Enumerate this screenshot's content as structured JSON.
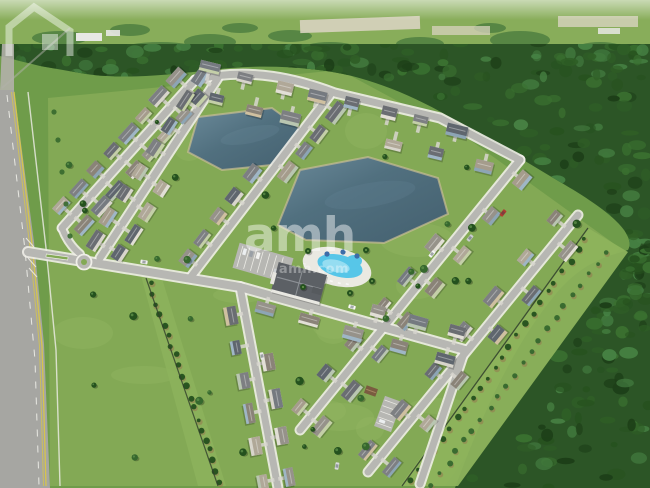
{
  "image_type": "aerial-photograph",
  "watermark": {
    "logo_text": "amh",
    "logo_caption": "amh.com",
    "icon": "house-outline-icon",
    "color": "rgba(255,255,255,0.45)",
    "color_dim": "rgba(255,255,255,0.34)"
  },
  "scene": {
    "description": "Aerial drone view of a suburban residential community with two retention ponds, a clubhouse and swimming pool amenity area, curving street grid, a main road on the left, planted buffer rows and dense forest on the right, distant farmland on the horizon",
    "colors": {
      "haze": "#c3d4c6",
      "field": "#88ad5a",
      "hedge": "#4b7c3e",
      "sand": "#d8d3bf",
      "structure": "#e8e8e4",
      "forest": "#2c5526",
      "lawn": "#83a955",
      "lawn_outer": "#6f9c4a",
      "lawn_light": "#97ba66",
      "buffer": "#8db35c",
      "pond": "#51707f",
      "pond_light": "#6b8a9a",
      "pond_deep": "#44606f",
      "bank": "#c9bd94",
      "road": "#a6a6a2",
      "road_faded": "#b2b1aa",
      "street": "#b7b7b3",
      "sidewalk": "#efeee8",
      "yellow_line": "#d6c54c",
      "white_line": "#f5f4ee",
      "deck": "#eae9e2",
      "pool": "#57c6e8",
      "pool_light": "#a5e2f2",
      "fence": "#2f3d2b",
      "drive": "#d8d6cf",
      "tree": "#36682e",
      "tree_dark": "#24511e",
      "mulch": "#96784e",
      "roofs": [
        "#7d7f82",
        "#6a6d72",
        "#96928a",
        "#a59c8c",
        "#5f666e",
        "#8a8378",
        "#b0a898",
        "#757a80"
      ],
      "walls": [
        "#d8d5cc",
        "#b9c6b1",
        "#9fb6c6",
        "#cfc0a0",
        "#8da5b5",
        "#c4cfa8",
        "#e2dfd6"
      ]
    }
  }
}
